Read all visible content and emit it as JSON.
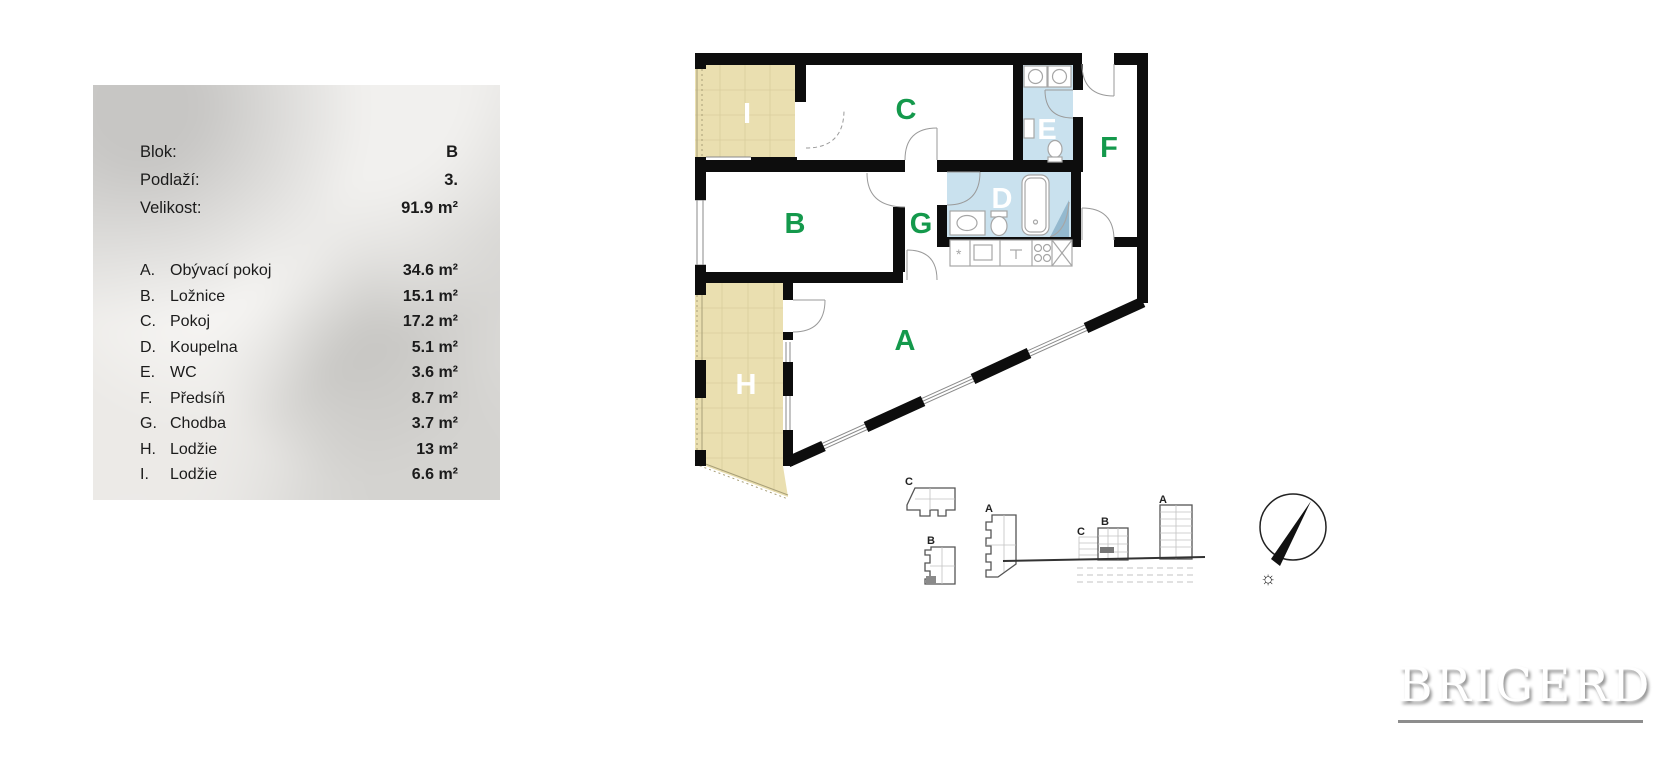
{
  "info_panel": {
    "fields": [
      {
        "label": "Blok:",
        "value": "B"
      },
      {
        "label": "Podlaží:",
        "value": "3."
      },
      {
        "label": "Velikost:",
        "value": "91.9 m²"
      }
    ],
    "rooms": [
      {
        "letter": "A.",
        "name": "Obývací pokoj",
        "area": "34.6 m²"
      },
      {
        "letter": "B.",
        "name": "Ložnice",
        "area": "15.1 m²"
      },
      {
        "letter": "C.",
        "name": "Pokoj",
        "area": "17.2 m²"
      },
      {
        "letter": "D.",
        "name": "Koupelna",
        "area": "5.1 m²"
      },
      {
        "letter": "E.",
        "name": "WC",
        "area": "3.6 m²"
      },
      {
        "letter": "F.",
        "name": "Předsíň",
        "area": "8.7 m²"
      },
      {
        "letter": "G.",
        "name": "Chodba",
        "area": "3.7 m²"
      },
      {
        "letter": "H.",
        "name": "Lodžie",
        "area": "13 m²"
      },
      {
        "letter": "I.",
        "name": "Lodžie",
        "area": "6.6 m²"
      }
    ]
  },
  "plan": {
    "room_labels": [
      {
        "letter": "A",
        "color": "#14994c"
      },
      {
        "letter": "B",
        "color": "#14994c"
      },
      {
        "letter": "C",
        "color": "#14994c"
      },
      {
        "letter": "D",
        "color": "#ffffff"
      },
      {
        "letter": "E",
        "color": "#ffffff"
      },
      {
        "letter": "F",
        "color": "#14994c"
      },
      {
        "letter": "G",
        "color": "#14994c"
      },
      {
        "letter": "H",
        "color": "#ffffff"
      },
      {
        "letter": "I",
        "color": "#ffffff"
      }
    ],
    "colors": {
      "wall": "#0d0d0d",
      "loggia_fill": "#eadfb0",
      "wet_room_fill": "#c9e1ee",
      "shower_fill": "#94b9cf",
      "label_green": "#14994c",
      "fixture_gray": "#a6a6a6"
    }
  },
  "key_plans": {
    "site": [
      "C",
      "B",
      "A"
    ],
    "elevation": [
      "C",
      "B",
      "A"
    ]
  },
  "compass": {
    "sun": "☼"
  },
  "logo": {
    "text": "BRIGERD"
  }
}
